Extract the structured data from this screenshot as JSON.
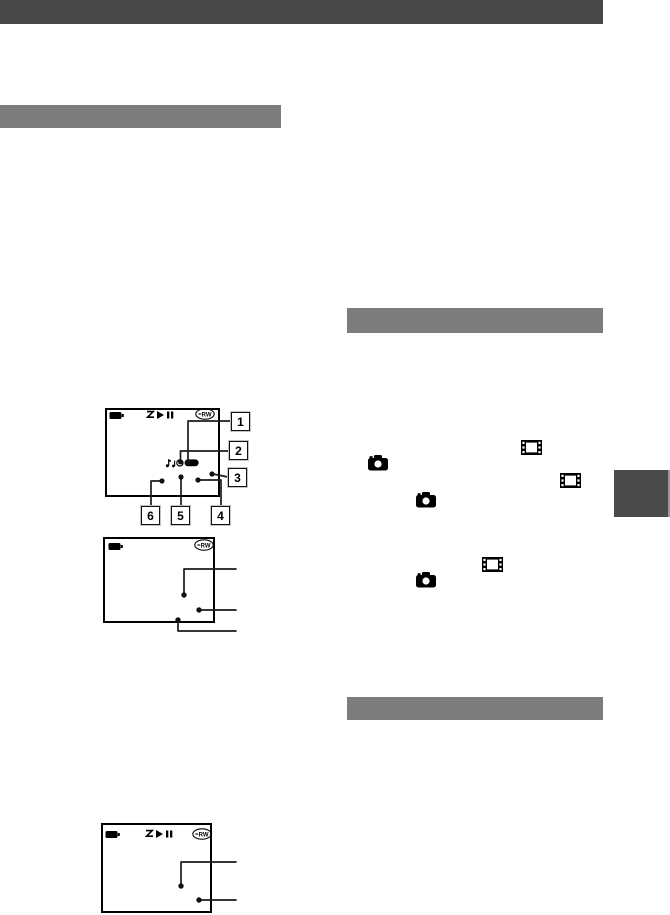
{
  "labels": {
    "rw_logo": "RW"
  },
  "colors": {
    "top_bar": "#484848",
    "section_bar": "#7d7d7d",
    "side_tab": "#4a4a4a",
    "side_tab_edge": "#9b9b9b",
    "ink": "#000000"
  },
  "icons": {
    "battery": "battery-icon",
    "dvd_rw": "dvd-rw-logo",
    "play_pause": "play-pause-icon",
    "standby": "z-indicator-icon",
    "melody": "note-indicator-icon",
    "volume": "volume-bar-icon",
    "film": "movie-film-icon",
    "camera": "still-camera-icon"
  },
  "figure1": {
    "callouts": [
      "1",
      "2",
      "3",
      "4",
      "5",
      "6"
    ]
  }
}
